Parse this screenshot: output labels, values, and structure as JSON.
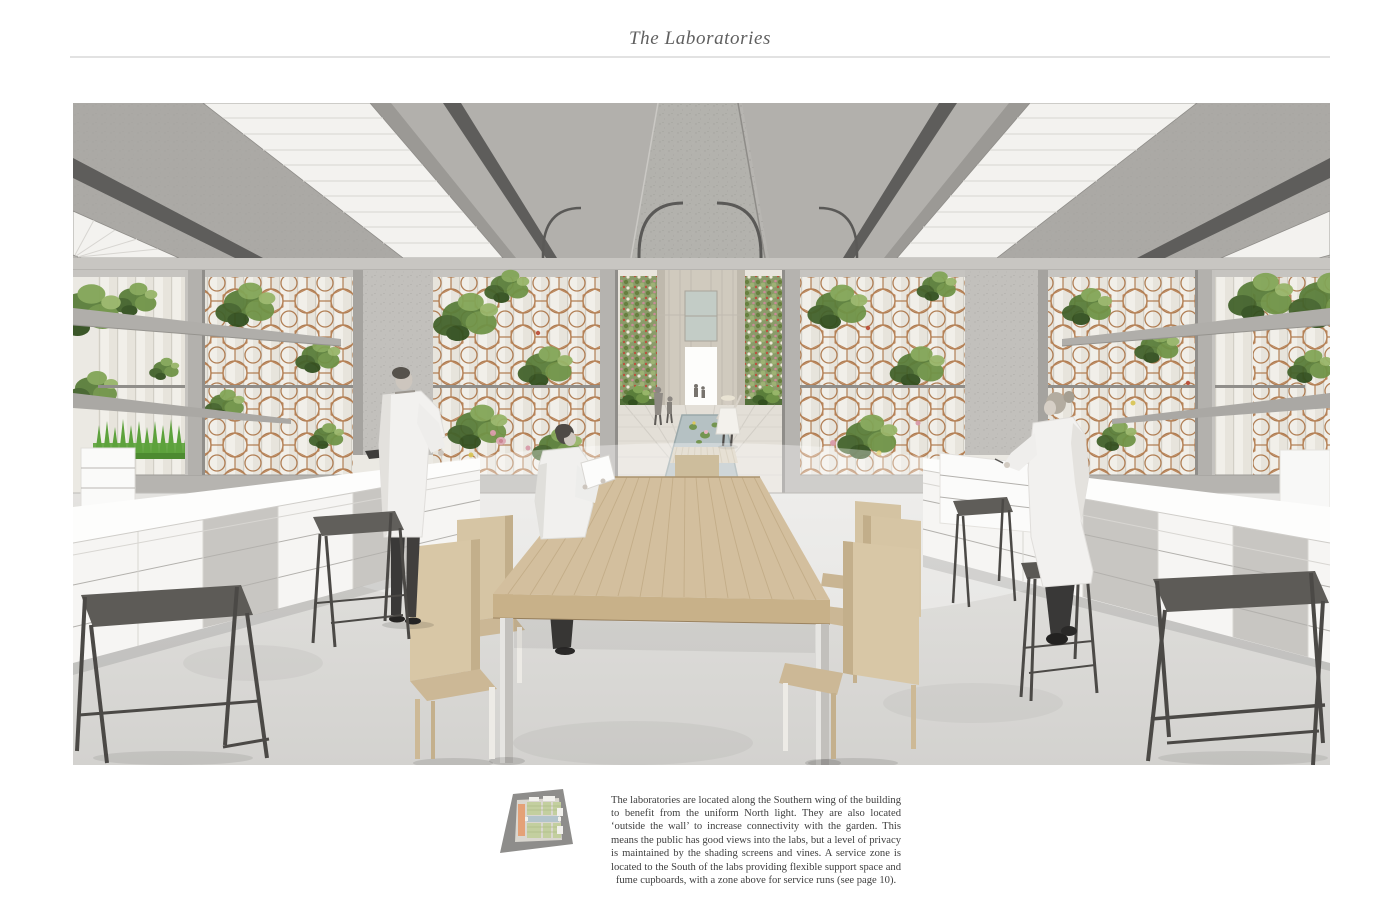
{
  "page": {
    "title": "The Laboratories"
  },
  "figure": {
    "rendering_label": "laboratory-interior-rendering",
    "plan_label": "site-plan-thumbnail"
  },
  "caption": {
    "text": "The laboratories are located along the Southern wing of the building to benefit from the uniform North light. They are also located ‘outside the wall’ to increase connectivity with the garden. This means the public has good views into the labs, but a level of privacy is maintained by the shading screens and vines. A service zone is located to the South of the labs providing flexible support space and fume cupboards, with a zone above for service runs (see page 10)."
  },
  "colors": {
    "title_gray": "#5f5f5f",
    "screen_rust": "#aa7244",
    "foliage_green": "#628a3f",
    "water_blue": "#b5c1c3",
    "plan_orange": "#e4a177",
    "concrete": "#b7b5b1",
    "table_wood": "#d3bf9e"
  }
}
